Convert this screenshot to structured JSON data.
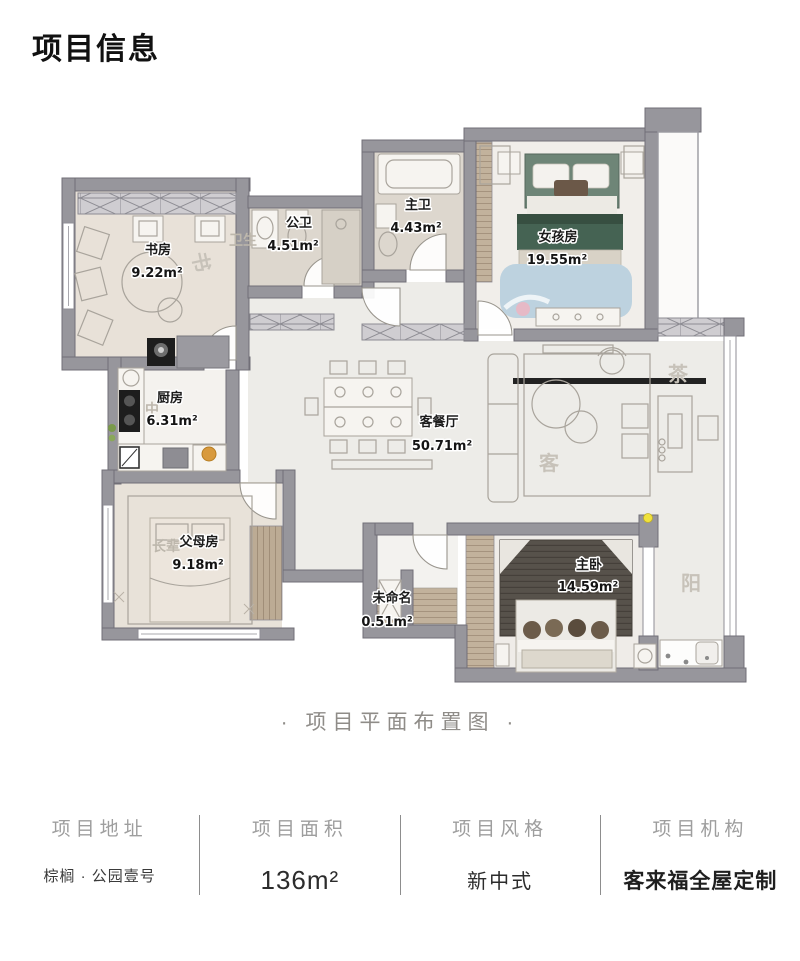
{
  "page_title": "项目信息",
  "caption": "·  项目平面布置图  ·",
  "floorplan": {
    "rooms": [
      {
        "name": "书房",
        "area": "9.22m²"
      },
      {
        "name": "公卫",
        "area": "4.51m²"
      },
      {
        "name": "主卫",
        "area": "4.43m²"
      },
      {
        "name": "女孩房",
        "area": "19.55m²"
      },
      {
        "name": "厨房",
        "area": "6.31m²"
      },
      {
        "name": "客餐厅",
        "area": "50.71m²"
      },
      {
        "name": "父母房",
        "area": "9.18m²"
      },
      {
        "name": "未命名",
        "area": "0.51m²"
      },
      {
        "name": "主卧",
        "area": "14.59m²"
      }
    ],
    "watermarks": [
      "书",
      "卫生",
      "中",
      "长辈",
      "客",
      "茶",
      "阳"
    ]
  },
  "palette": {
    "wall_gray": "#97969c",
    "wood": "#c2b29c",
    "girl_bed_green": "#456353",
    "girl_frame_green": "#6e8577",
    "master_panel_brown": "#57524b",
    "rug_blue": "#bdd2df",
    "accent_yellow": "#f0e23c",
    "stove_black": "#1d1d1d"
  },
  "footer": {
    "columns": [
      {
        "label": "项目地址",
        "value": "棕榈 · 公园壹号"
      },
      {
        "label": "项目面积",
        "value": "136m²"
      },
      {
        "label": "项目风格",
        "value": "新中式"
      },
      {
        "label": "项目机构",
        "value": "客来福全屋定制"
      }
    ]
  }
}
